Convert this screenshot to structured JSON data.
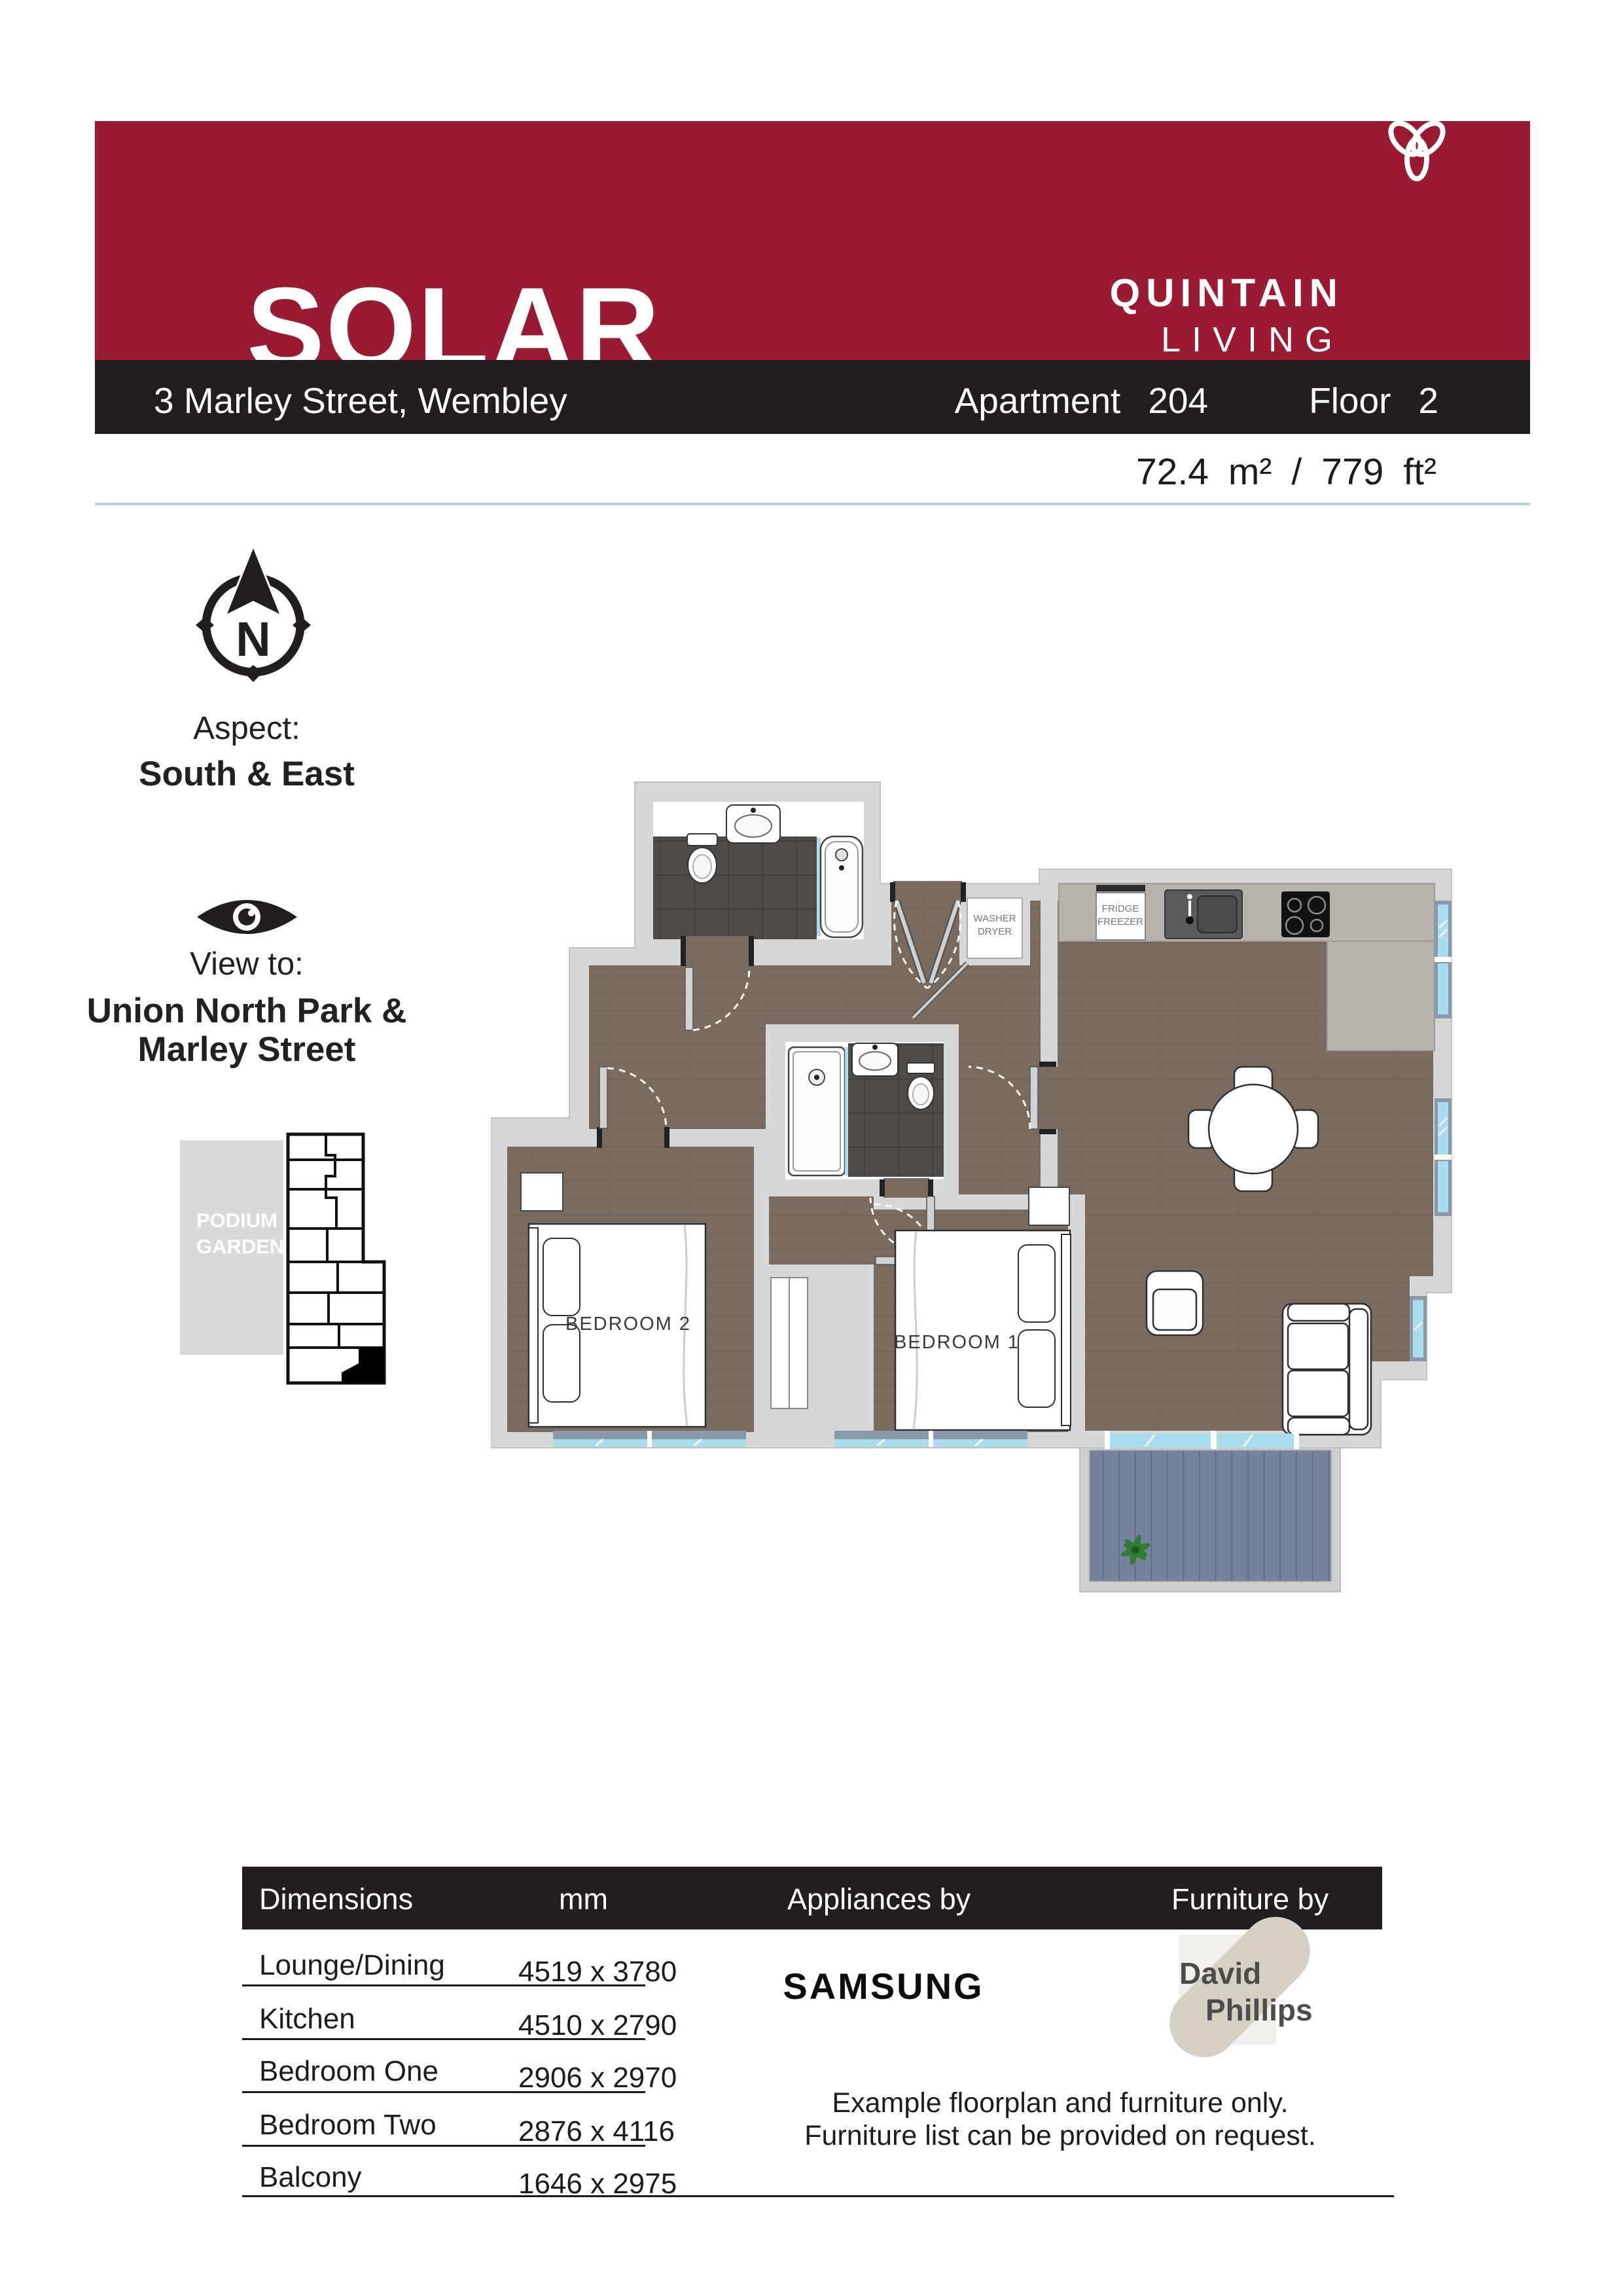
{
  "header": {
    "development": "SOLAR",
    "subtitle": "2 Bed Apartment",
    "brand_line1": "QUINTAIN",
    "brand_line2": "LIVING"
  },
  "address_bar": {
    "address": "3 Marley Street, Wembley",
    "apartment_label": "Apartment",
    "apartment_number": "204",
    "floor_label": "Floor",
    "floor_number": "2"
  },
  "area": {
    "metric_value": "72.4",
    "metric_unit": "m²",
    "separator": "/",
    "imperial_value": "779",
    "imperial_unit": "ft²"
  },
  "aspect": {
    "heading": "Aspect:",
    "value": "South & East",
    "compass_letter": "N"
  },
  "view": {
    "heading": "View to:",
    "value_line1": "Union North Park &",
    "value_line2": "Marley Street"
  },
  "key_plan": {
    "garden_label_line1": "PODIUM",
    "garden_label_line2": "GARDEN"
  },
  "floorplan": {
    "bedroom1_label": "BEDROOM 1",
    "bedroom2_label": "BEDROOM 2",
    "washer_line1": "WASHER",
    "washer_line2": "DRYER",
    "fridge_line1": "FRIDGE",
    "fridge_line2": "FREEZER"
  },
  "dimensions_table": {
    "headers": {
      "dimensions": "Dimensions",
      "unit": "mm",
      "appliances": "Appliances by",
      "furniture": "Furniture by"
    },
    "rows": [
      {
        "room": "Lounge/Dining",
        "size": "4519 x 3780"
      },
      {
        "room": "Kitchen",
        "size": "4510 x 2790"
      },
      {
        "room": "Bedroom One",
        "size": "2906 x 2970"
      },
      {
        "room": "Bedroom Two",
        "size": "2876 x 4116"
      },
      {
        "room": "Balcony",
        "size": "1646 x 2975"
      }
    ],
    "appliances_brand": "SAMSUNG",
    "furniture_brand_line1": "David",
    "furniture_brand_line2": "Phillips",
    "note_line1": "Example floorplan and furniture only.",
    "note_line2": "Furniture list can be provided on request."
  },
  "colors": {
    "accent_red": "#9A1B31",
    "bar_black": "#221E1F",
    "teal_rule": "#B7D3D7",
    "wood_floor": "#7B6B5F",
    "bathroom_tile": "#4D4A47",
    "wall_gray": "#D7D7D7",
    "kitchen_counter": "#B8B3AC",
    "window_glass": "#A9DCEC",
    "window_frame": "#8A99A9",
    "balcony_decking": "#76829B",
    "furniture_brand_tan": "#D7D0C5"
  }
}
